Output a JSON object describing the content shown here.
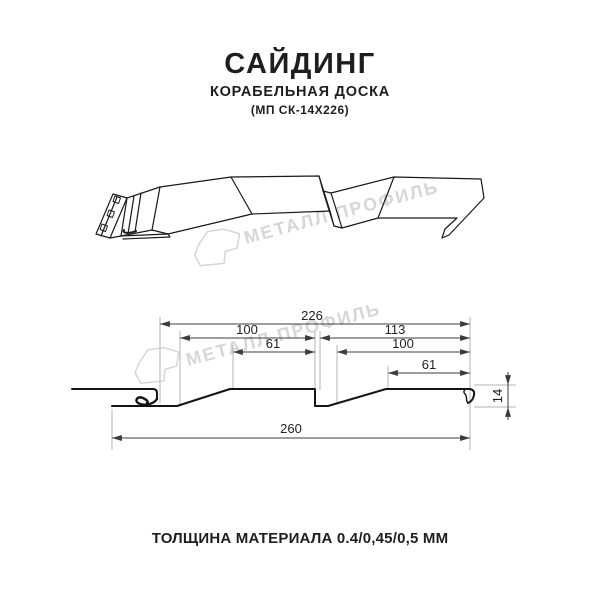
{
  "header": {
    "title": "САЙДИНГ",
    "subtitle": "КОРАБЕЛЬНАЯ ДОСКА",
    "model": "(МП СК-14Х226)"
  },
  "watermark": {
    "brand": "МЕТАЛЛ ПРОФИЛЬ",
    "logo_icon": "metal-profil-folded-ribbon-logo",
    "color": "#d6d6d6"
  },
  "dimensions": {
    "top_width": "226",
    "left_upper": "100",
    "right_upper": "113",
    "left_inner": "61",
    "right_inner": "100",
    "right_small": "61",
    "total_width": "260",
    "height": "14"
  },
  "footer": {
    "thickness_label": "ТОЛЩИНА МАТЕРИАЛА 0.4/0,45/0,5 ММ"
  },
  "colors": {
    "drawing_line": "#1a1a1a",
    "section_line": "#141414",
    "dimension_line": "#3c3c3c",
    "extension_line": "#b4b4b4",
    "text": "#1e1e1e",
    "background": "#ffffff"
  }
}
